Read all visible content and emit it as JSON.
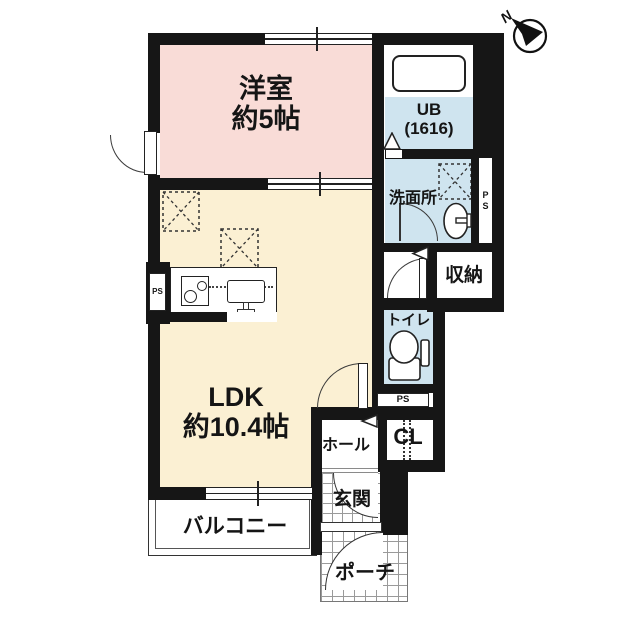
{
  "compass": {
    "north_label": "N"
  },
  "rooms": {
    "western_room": {
      "name": "洋室",
      "size": "約5帖"
    },
    "ldk": {
      "name": "LDK",
      "size": "約10.4帖"
    },
    "unit_bath": {
      "name": "UB",
      "size": "(1616)"
    },
    "washroom": {
      "name": "洗面所"
    },
    "storage": {
      "name": "収納"
    },
    "toilet": {
      "name": "トイレ"
    },
    "hall": {
      "name": "ホール"
    },
    "closet": {
      "name": "CL"
    },
    "entrance": {
      "name": "玄関"
    },
    "porch": {
      "name": "ポーチ"
    },
    "balcony": {
      "name": "バルコニー"
    }
  },
  "labels": {
    "pipe_space": "PS"
  },
  "colors": {
    "wall": "#161616",
    "western_room_fill": "#f9dcd7",
    "ldk_fill": "#fbf0d3",
    "wet_area_fill": "#cfe4ef"
  }
}
